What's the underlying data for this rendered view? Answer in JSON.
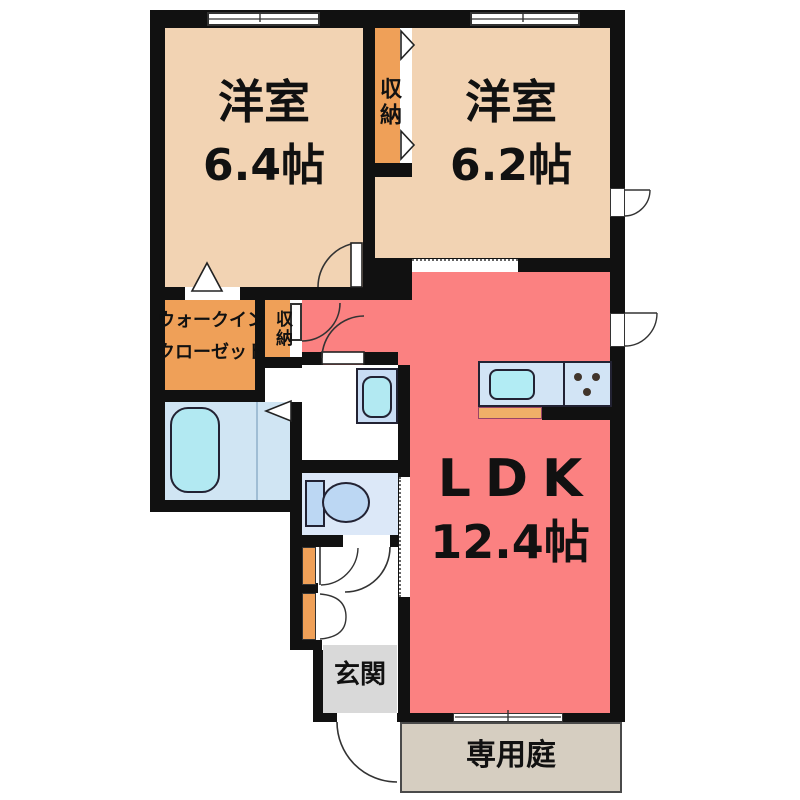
{
  "floorplan": {
    "rooms": {
      "bedroom_64": {
        "name": "洋室",
        "area": "6.4帖"
      },
      "bedroom_62": {
        "name": "洋室",
        "area": "6.2帖"
      },
      "ldk": {
        "name": "LDK",
        "area": "12.4帖"
      },
      "walk_in_closet": {
        "line1": "ウォークイン",
        "line2": "クローゼット"
      },
      "closet_between_bedrooms": {
        "name": "収納"
      },
      "closet_hall": {
        "name": "収納"
      },
      "entrance": {
        "name": "玄関"
      },
      "private_garden": {
        "name": "専用庭"
      }
    },
    "colors": {
      "wall": "#111111",
      "bedroom": "#f2d3b3",
      "closet": "#efa058",
      "ldk": "#fb8181",
      "bathroom": "#d0e5f3",
      "toilet_room": "#dce8f8",
      "fixture_blue": "#bcd7f3",
      "tub_cyan": "#b2e9f2",
      "kitchen_counter": "#d2e4f5",
      "counter_strip": "#f0b068",
      "entrance_floor": "#d9d9d9",
      "garden": "#d6cec1"
    }
  }
}
